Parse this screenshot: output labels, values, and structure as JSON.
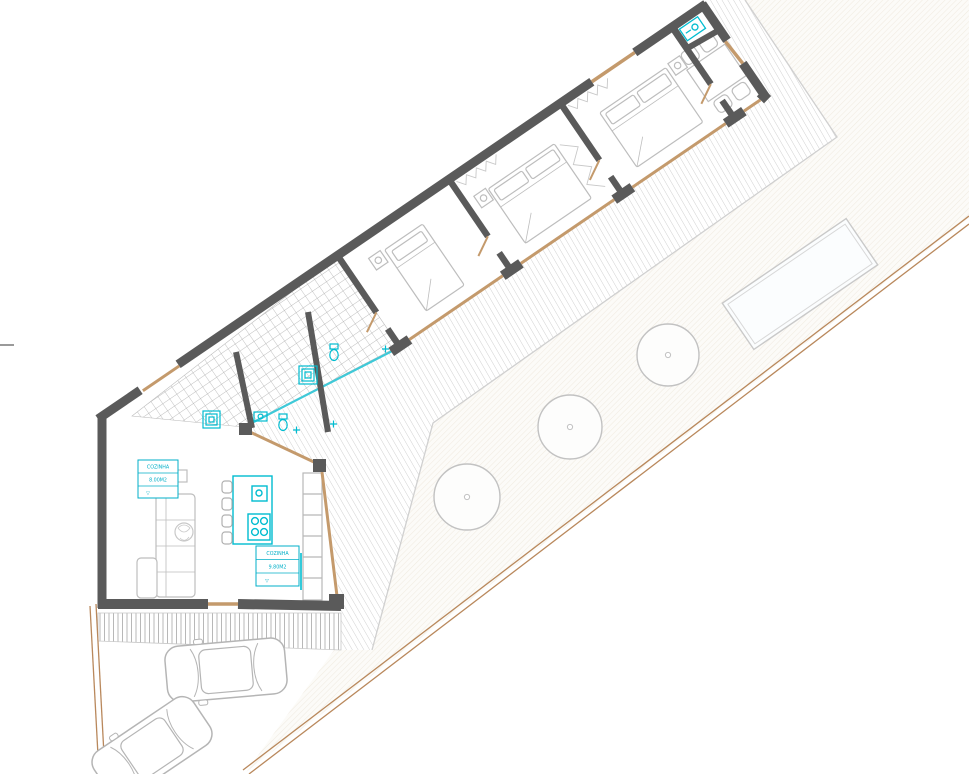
{
  "drawing": {
    "type": "architectural-floor-plan",
    "labels": {
      "living": {
        "name": "COZINHA",
        "area": "8.00M2",
        "marker": "▽"
      },
      "kitchen": {
        "name": "COZINHA",
        "area": "9.80M2",
        "marker": "▽"
      }
    },
    "colors": {
      "wall": "#5a5a5a",
      "fixture_cyan": "#00bcd0",
      "label_cyan": "#00afc8",
      "door_tan": "#c49a6c",
      "boundary_tan": "#b9885c",
      "furniture_gray": "#bdbdbd",
      "deck_hatch": "#cccccc",
      "tile_grid": "#a9a9a9"
    },
    "elements": {
      "trees": 3,
      "cars": 2,
      "beds": 3,
      "pool": 1
    }
  }
}
